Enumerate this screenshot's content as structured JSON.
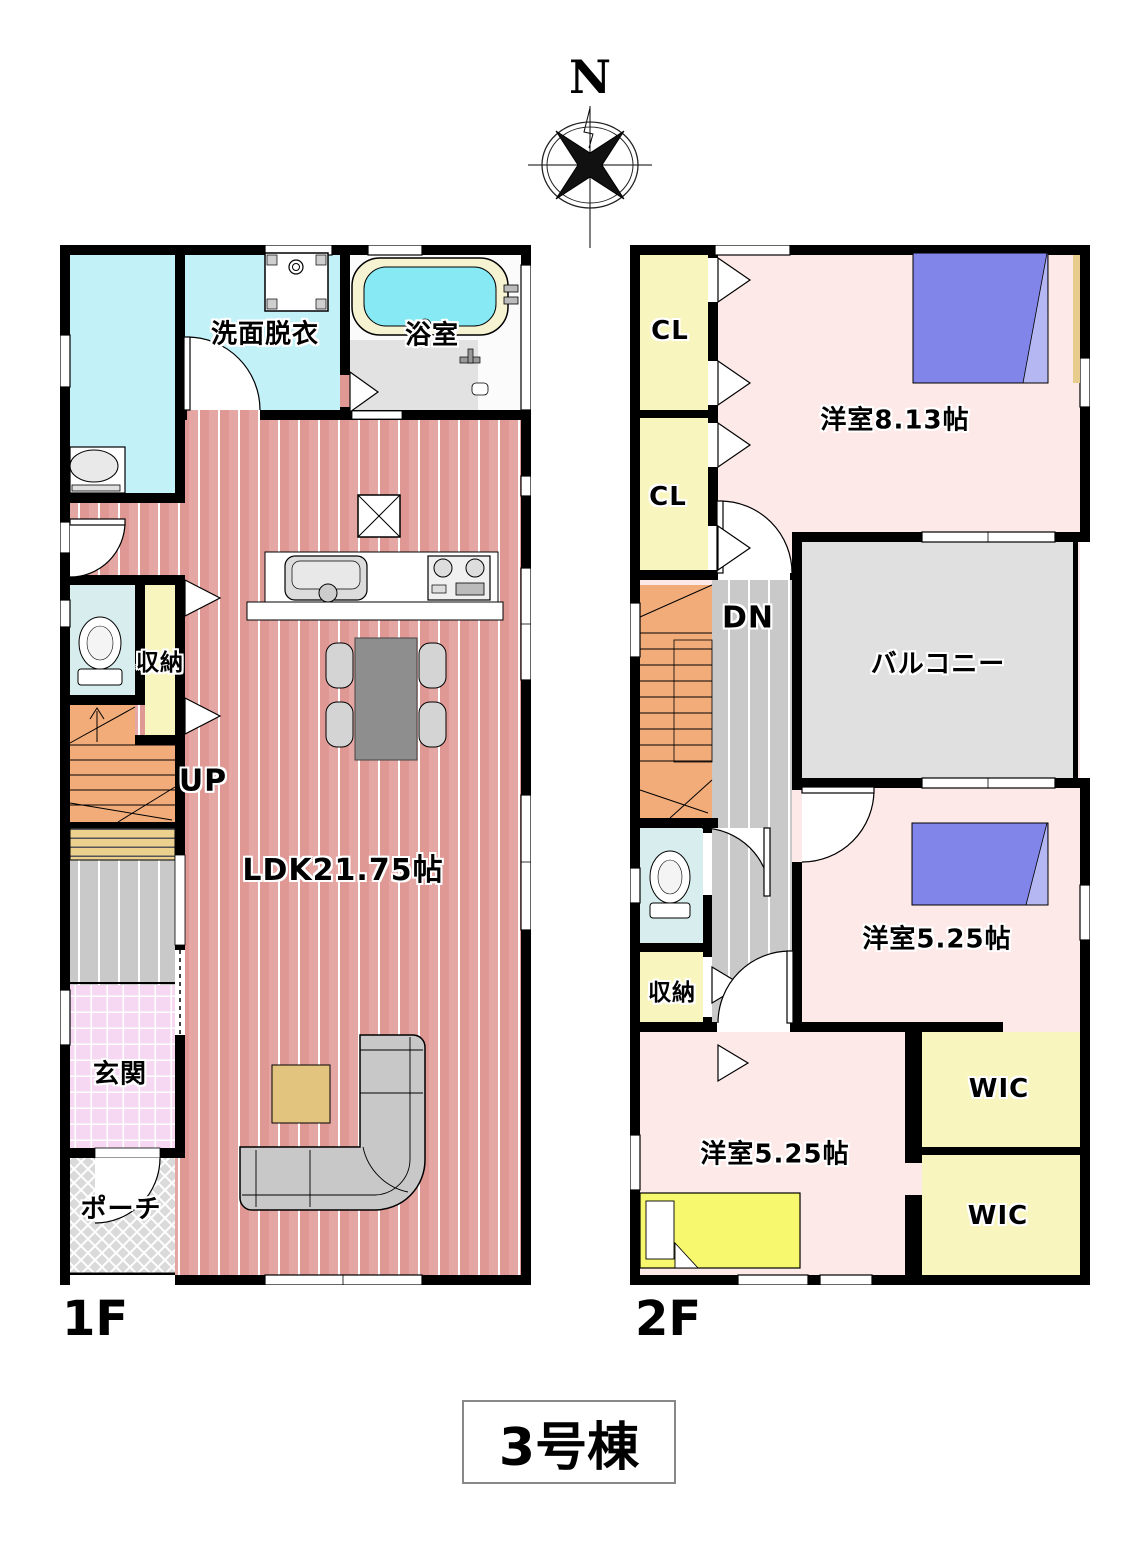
{
  "title": "3号棟",
  "compass": {
    "north_label": "N"
  },
  "floors": {
    "f1": {
      "label": "1F",
      "rooms": {
        "washroom": "洗面脱衣",
        "bath": "浴室",
        "storage": "収納",
        "stairs": "UP",
        "ldk": "LDK21.75帖",
        "entrance": "玄関",
        "porch": "ポーチ"
      }
    },
    "f2": {
      "label": "2F",
      "rooms": {
        "closet1": "CL",
        "closet2": "CL",
        "bedroom1": "洋室8.13帖",
        "stairs": "DN",
        "balcony": "バルコニー",
        "bedroom2": "洋室5.25帖",
        "storage": "収納",
        "wic1": "WIC",
        "bedroom3": "洋室5.25帖",
        "wic2": "WIC"
      }
    }
  },
  "colors": {
    "wall_black": "#000000",
    "ldk_floor": "#e09894",
    "bedroom_floor": "#fde9e7",
    "closet_yellow": "#f8f5be",
    "stairs_orange": "#f2ac7a",
    "hallway_gray": "#c9c9c9",
    "balcony_gray": "#e0e0e0",
    "entrance_tile_pink": "#f6d8f2",
    "porch_gray": "#dadada",
    "washroom_cyan": "#c2f1f8",
    "toilet_blue": "#d8eded",
    "bathtub_water": "#86e9f3",
    "bed_blue": "#8184e8",
    "bed_yellow": "#f8f86e",
    "shoe_cabinet_tan": "#ecd08d"
  }
}
